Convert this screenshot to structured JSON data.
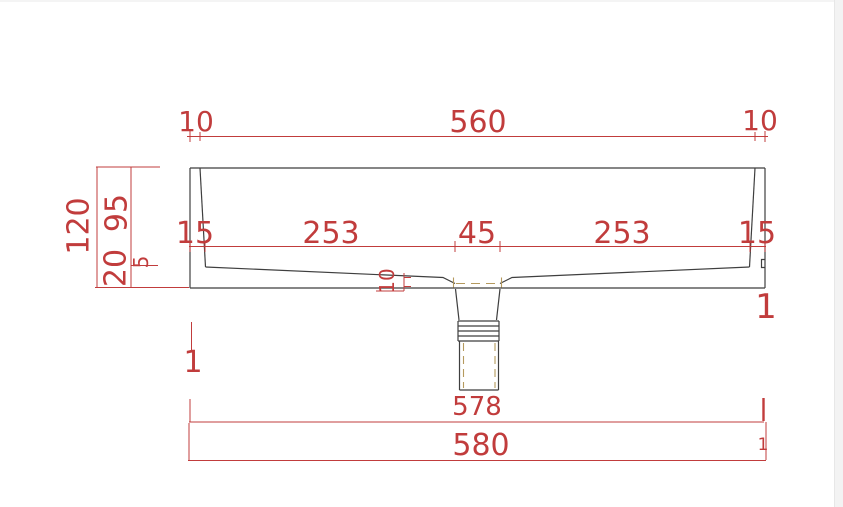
{
  "drawing": {
    "type": "cad-technical-drawing",
    "subject": "wash basin front cross-section with drain pipe",
    "units": "mm"
  },
  "colors": {
    "dimension_red": "#c13c3c",
    "outline_black": "#3f3f3f",
    "hidden_tan": "#b59a5e",
    "background": "#ffffff",
    "margin_gray": "#f3f3f3"
  },
  "labels": {
    "top_left_rim": "10",
    "top_width": "560",
    "top_right_rim": "10",
    "total_height": "120",
    "inner_depth": "95",
    "slope_step": "5",
    "base_thickness": "20",
    "wall_left": "15",
    "span_left": "253",
    "drain_width": "45",
    "span_right": "253",
    "wall_right": "15",
    "recess_depth": "10",
    "bottom_inner_width": "578",
    "bottom_outer_width": "580",
    "mark_left": "1",
    "mark_right": "1",
    "mark_bottom_right": "1"
  }
}
